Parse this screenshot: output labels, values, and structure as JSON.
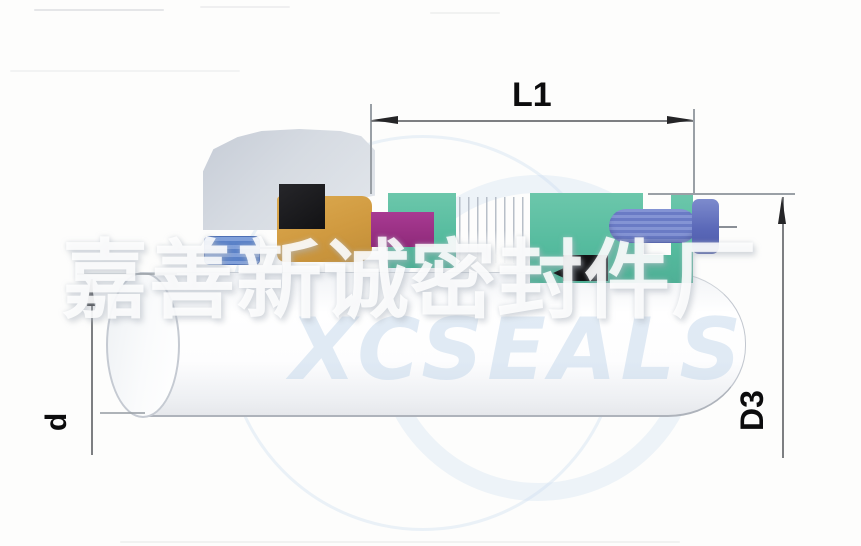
{
  "diagram": {
    "type": "mechanical-seal-cross-section",
    "dimension_labels": {
      "length": "L1",
      "shaft_diameter": "d",
      "outer_diameter": "D3"
    },
    "watermark": {
      "company_cn": "嘉善新诚密封件厂",
      "ghost_brand": "XCSEALS"
    },
    "colors": {
      "gland_gray": "#ccd1da",
      "seal_face_black": "#1b1b1d",
      "collar_orange": "#d09a40",
      "sleeve_blue": "#5b82c8",
      "oring_magenta": "#9c2f86",
      "retainer_teal": "#55bb9e",
      "screw_body_blue": "#6a7bc5",
      "screw_head_blue": "#5a68b8",
      "clip_black": "#121214",
      "dimension_line_gray": "#7d7f82",
      "shaft_edge_gray": "#aeb3bb",
      "ghost_blue": "#cbdeef"
    }
  }
}
